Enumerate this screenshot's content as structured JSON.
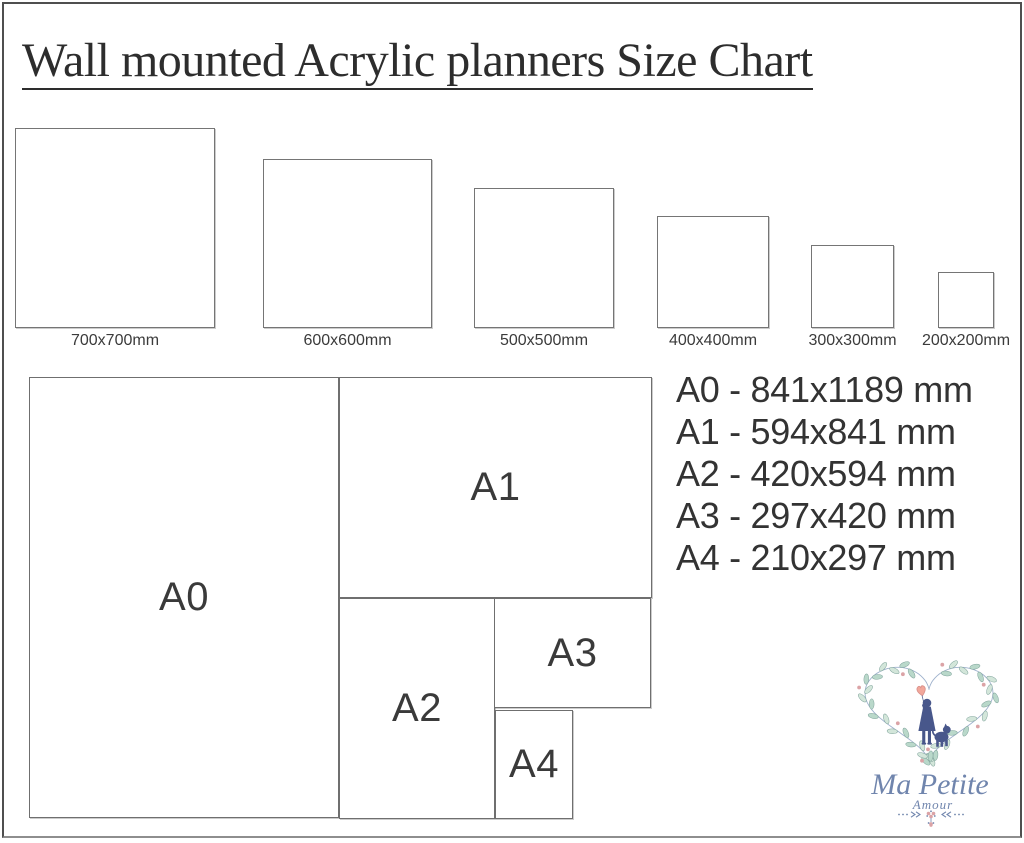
{
  "title": "Wall mounted Acrylic planners Size Chart",
  "squares": [
    {
      "label": "700x700mm"
    },
    {
      "label": "600x600mm"
    },
    {
      "label": "500x500mm"
    },
    {
      "label": "400x400mm"
    },
    {
      "label": "300x300mm"
    },
    {
      "label": "200x200mm"
    }
  ],
  "diagram": {
    "a0": "A0",
    "a1": "A1",
    "a2": "A2",
    "a3": "A3",
    "a4": "A4"
  },
  "sizes": [
    "A0 - 841x1189 mm",
    "A1 - 594x841 mm",
    "A2 - 420x594 mm",
    "A3 - 297x420 mm",
    "A4 - 210x297 mm"
  ],
  "logo": {
    "name": "Ma Petite",
    "subtitle": "Amour"
  },
  "colors": {
    "frame": "#4f4f4f",
    "box_border": "#757575",
    "text_dark": "#333333",
    "logo_navy": "#48578b",
    "logo_blue": "#7085ad",
    "stem_blue": "#93a9c6",
    "leaf_green": "#b9d8ca",
    "leaf_green_light": "#d3e6da",
    "leaf_stroke": "#7fa39b",
    "flower_pink": "#dba3a6",
    "balloon_pink": "#f2a79b",
    "balloon_stroke": "#d8908a"
  }
}
